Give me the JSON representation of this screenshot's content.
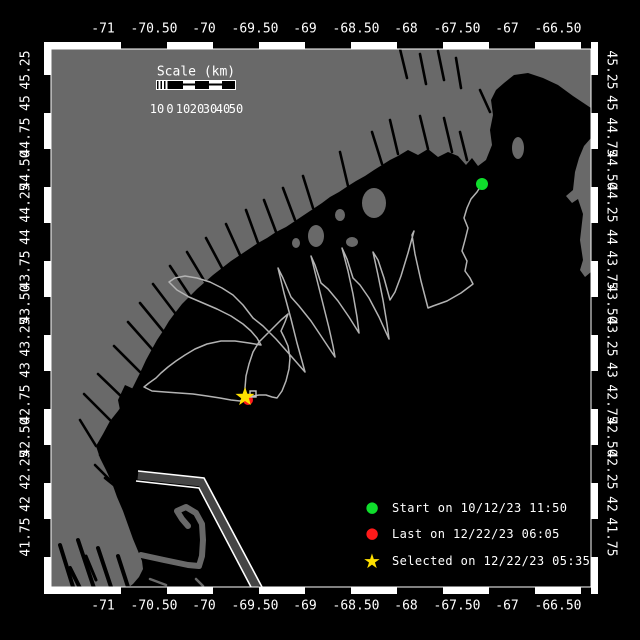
{
  "colors": {
    "background": "#000000",
    "land": "#696969",
    "track": "#b3b3b3",
    "frame_white": "#ffffff",
    "lane_separator": "#454545",
    "start_green": "#0fdd2c",
    "last_red": "#ff1a1a",
    "selected_yellow": "#ffe000"
  },
  "axes": {
    "top_labels": [
      {
        "text": "-71",
        "x": 103
      },
      {
        "text": "-70.50",
        "x": 154
      },
      {
        "text": "-70",
        "x": 204
      },
      {
        "text": "-69.50",
        "x": 255
      },
      {
        "text": "-69",
        "x": 305
      },
      {
        "text": "-68.50",
        "x": 356
      },
      {
        "text": "-68",
        "x": 406
      },
      {
        "text": "-67.50",
        "x": 457
      },
      {
        "text": "-67",
        "x": 507
      },
      {
        "text": "-66.50",
        "x": 558
      }
    ],
    "bottom_labels": [
      {
        "text": "-71",
        "x": 103
      },
      {
        "text": "-70.50",
        "x": 154
      },
      {
        "text": "-70",
        "x": 204
      },
      {
        "text": "-69.50",
        "x": 255
      },
      {
        "text": "-69",
        "x": 305
      },
      {
        "text": "-68.50",
        "x": 356
      },
      {
        "text": "-68",
        "x": 406
      },
      {
        "text": "-67.50",
        "x": 457
      },
      {
        "text": "-67",
        "x": 507
      },
      {
        "text": "-66.50",
        "x": 558
      }
    ],
    "left_labels": [
      {
        "text": "45.25",
        "y": 70
      },
      {
        "text": "45",
        "y": 103
      },
      {
        "text": "44.75",
        "y": 137
      },
      {
        "text": "44.50",
        "y": 170
      },
      {
        "text": "44.25",
        "y": 203
      },
      {
        "text": "44",
        "y": 237
      },
      {
        "text": "43.75",
        "y": 270
      },
      {
        "text": "43.50",
        "y": 304
      },
      {
        "text": "43.25",
        "y": 337
      },
      {
        "text": "43",
        "y": 370
      },
      {
        "text": "42.75",
        "y": 404
      },
      {
        "text": "42.50",
        "y": 437
      },
      {
        "text": "42.25",
        "y": 470
      },
      {
        "text": "42",
        "y": 504
      },
      {
        "text": "41.75",
        "y": 537
      }
    ],
    "right_labels": [
      {
        "text": "45.25",
        "y": 70
      },
      {
        "text": "45",
        "y": 103
      },
      {
        "text": "44.75",
        "y": 137
      },
      {
        "text": "44.50",
        "y": 170
      },
      {
        "text": "44.25",
        "y": 203
      },
      {
        "text": "44",
        "y": 237
      },
      {
        "text": "43.75",
        "y": 270
      },
      {
        "text": "43.50",
        "y": 304
      },
      {
        "text": "43.25",
        "y": 337
      },
      {
        "text": "43",
        "y": 370
      },
      {
        "text": "42.75",
        "y": 404
      },
      {
        "text": "42.50",
        "y": 437
      },
      {
        "text": "42.25",
        "y": 470
      },
      {
        "text": "42",
        "y": 504
      },
      {
        "text": "41.75",
        "y": 537
      }
    ]
  },
  "scale_bar": {
    "title": "Scale (km)",
    "tick_labels": [
      {
        "text": "10",
        "x": 157
      },
      {
        "text": "0",
        "x": 170
      },
      {
        "text": "10",
        "x": 183
      },
      {
        "text": "20",
        "x": 197
      },
      {
        "text": "30",
        "x": 210
      },
      {
        "text": "40",
        "x": 223
      },
      {
        "text": "50",
        "x": 236
      }
    ]
  },
  "legend": {
    "items": [
      {
        "marker": "circle",
        "color_key": "start_green",
        "label": "Start on 10/12/23 11:50",
        "y": 510
      },
      {
        "marker": "circle",
        "color_key": "last_red",
        "label": "Last on 12/22/23 06:05",
        "y": 536
      },
      {
        "marker": "star",
        "color_key": "selected_yellow",
        "label": "Selected on 12/22/23 05:35",
        "y": 561
      }
    ]
  },
  "map": {
    "markers": {
      "start": {
        "x": 482,
        "y": 184
      },
      "last": {
        "x": 248,
        "y": 400
      },
      "selected": {
        "x": 245,
        "y": 397
      },
      "selected_box": {
        "x": 250,
        "y": 391
      }
    },
    "track_points": [
      [
        482,
        184
      ],
      [
        477,
        192
      ],
      [
        471,
        199
      ],
      [
        467,
        208
      ],
      [
        464,
        218
      ],
      [
        468,
        228
      ],
      [
        465,
        240
      ],
      [
        462,
        251
      ],
      [
        467,
        261
      ],
      [
        465,
        271
      ],
      [
        470,
        278
      ],
      [
        473,
        284
      ],
      [
        461,
        293
      ],
      [
        447,
        301
      ],
      [
        433,
        306
      ],
      [
        428,
        308
      ],
      [
        421,
        281
      ],
      [
        415,
        254
      ],
      [
        412,
        235
      ],
      [
        414,
        231
      ],
      [
        408,
        253
      ],
      [
        401,
        276
      ],
      [
        395,
        292
      ],
      [
        390,
        300
      ],
      [
        384,
        278
      ],
      [
        378,
        260
      ],
      [
        373,
        252
      ],
      [
        378,
        275
      ],
      [
        383,
        300
      ],
      [
        387,
        324
      ],
      [
        389,
        339
      ],
      [
        379,
        317
      ],
      [
        369,
        298
      ],
      [
        360,
        285
      ],
      [
        353,
        278
      ],
      [
        347,
        259
      ],
      [
        342,
        248
      ],
      [
        348,
        271
      ],
      [
        353,
        294
      ],
      [
        357,
        317
      ],
      [
        359,
        333
      ],
      [
        349,
        317
      ],
      [
        338,
        301
      ],
      [
        328,
        289
      ],
      [
        321,
        283
      ],
      [
        315,
        265
      ],
      [
        311,
        256
      ],
      [
        317,
        280
      ],
      [
        323,
        304
      ],
      [
        329,
        328
      ],
      [
        333,
        346
      ],
      [
        335,
        357
      ],
      [
        323,
        339
      ],
      [
        311,
        321
      ],
      [
        299,
        306
      ],
      [
        291,
        297
      ],
      [
        283,
        278
      ],
      [
        278,
        268
      ],
      [
        284,
        293
      ],
      [
        291,
        319
      ],
      [
        297,
        343
      ],
      [
        302,
        361
      ],
      [
        305,
        372
      ],
      [
        291,
        356
      ],
      [
        276,
        339
      ],
      [
        263,
        326
      ],
      [
        253,
        318
      ],
      [
        243,
        305
      ],
      [
        233,
        295
      ],
      [
        222,
        288
      ],
      [
        210,
        282
      ],
      [
        197,
        278
      ],
      [
        185,
        276
      ],
      [
        175,
        278
      ],
      [
        169,
        282
      ],
      [
        177,
        290
      ],
      [
        189,
        297
      ],
      [
        203,
        303
      ],
      [
        217,
        309
      ],
      [
        231,
        316
      ],
      [
        243,
        324
      ],
      [
        251,
        331
      ],
      [
        257,
        338
      ],
      [
        261,
        345
      ],
      [
        249,
        343
      ],
      [
        235,
        341
      ],
      [
        221,
        341
      ],
      [
        207,
        344
      ],
      [
        195,
        349
      ],
      [
        185,
        355
      ],
      [
        176,
        361
      ],
      [
        168,
        367
      ],
      [
        161,
        373
      ],
      [
        156,
        378
      ],
      [
        149,
        383
      ],
      [
        144,
        387
      ],
      [
        152,
        391
      ],
      [
        165,
        392
      ],
      [
        179,
        393
      ],
      [
        193,
        394
      ],
      [
        207,
        396
      ],
      [
        220,
        398
      ],
      [
        231,
        400
      ],
      [
        240,
        401
      ],
      [
        247,
        398
      ],
      [
        253,
        396
      ],
      [
        259,
        395
      ],
      [
        266,
        395
      ],
      [
        272,
        397
      ],
      [
        277,
        398
      ],
      [
        282,
        391
      ],
      [
        286,
        381
      ],
      [
        289,
        369
      ],
      [
        290,
        358
      ],
      [
        288,
        346
      ],
      [
        284,
        337
      ],
      [
        281,
        331
      ],
      [
        285,
        322
      ],
      [
        288,
        314
      ],
      [
        281,
        320
      ],
      [
        273,
        328
      ],
      [
        265,
        336
      ],
      [
        259,
        342
      ],
      [
        253,
        352
      ],
      [
        249,
        364
      ],
      [
        246,
        376
      ],
      [
        245,
        388
      ],
      [
        246,
        395
      ],
      [
        248,
        400
      ]
    ]
  }
}
